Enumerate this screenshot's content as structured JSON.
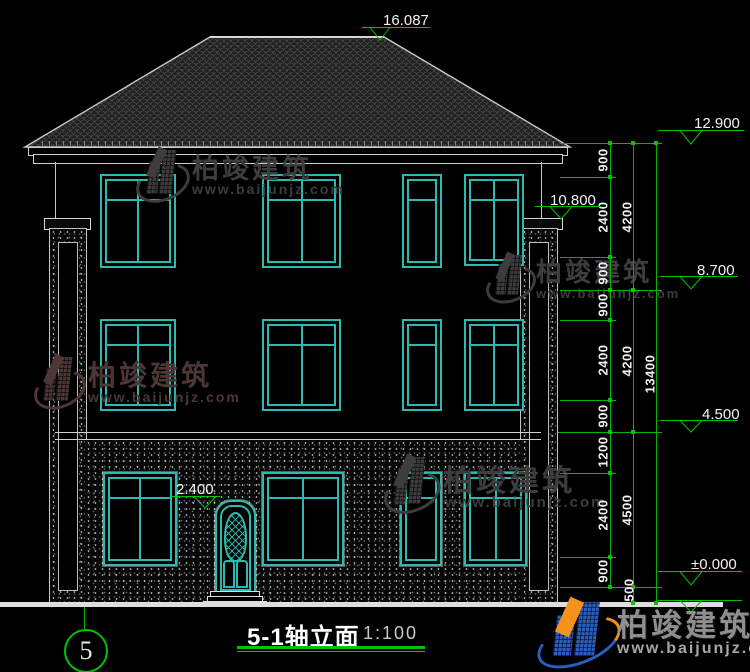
{
  "drawing": {
    "title": "5-1轴立面",
    "scale": "1:100",
    "axis_label": "5"
  },
  "levels": {
    "ridge": "16.087",
    "roof_top": "12.900",
    "eave": "10.800",
    "floor3_top": "8.700",
    "floor2_top": "4.500",
    "door_top": "2.400",
    "ground": "±0.000"
  },
  "dims": {
    "c1": [
      "900",
      "2400",
      "900",
      "900",
      "2400",
      "900",
      "1200",
      "2400",
      "900"
    ],
    "c2": [
      "4200",
      "4200",
      "4500",
      "500"
    ],
    "c3": [
      "13400"
    ]
  },
  "watermark": {
    "company": "柏竣建筑",
    "website": "www.baijunjz.com"
  }
}
